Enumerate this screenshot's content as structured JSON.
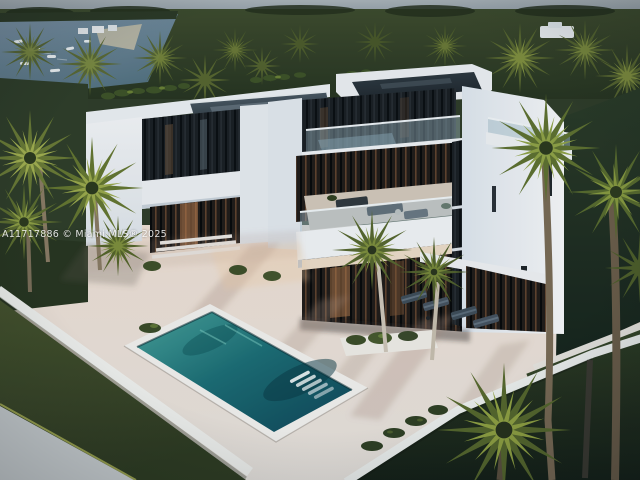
{
  "watermark": {
    "text": "A11717886 © Miami MLS® 2025"
  },
  "scene": {
    "subject": "aerial-view-modern-white-villa-with-pool",
    "colors": {
      "sky": "#9aa4ac",
      "tree_canopy": "#33402a",
      "palm_frond_light": "#a2ae4e",
      "palm_frond_dark": "#57682c",
      "villa_white": "#f2f4f6",
      "glazing_dark": "#1a1f23",
      "warm_interior": "#c08050",
      "pool_teal": "#1c6d74",
      "pool_deep": "#0e4456",
      "deck": "#e9e1d8",
      "lawn": "#3a4826",
      "bay_water": "#6a8496"
    }
  }
}
